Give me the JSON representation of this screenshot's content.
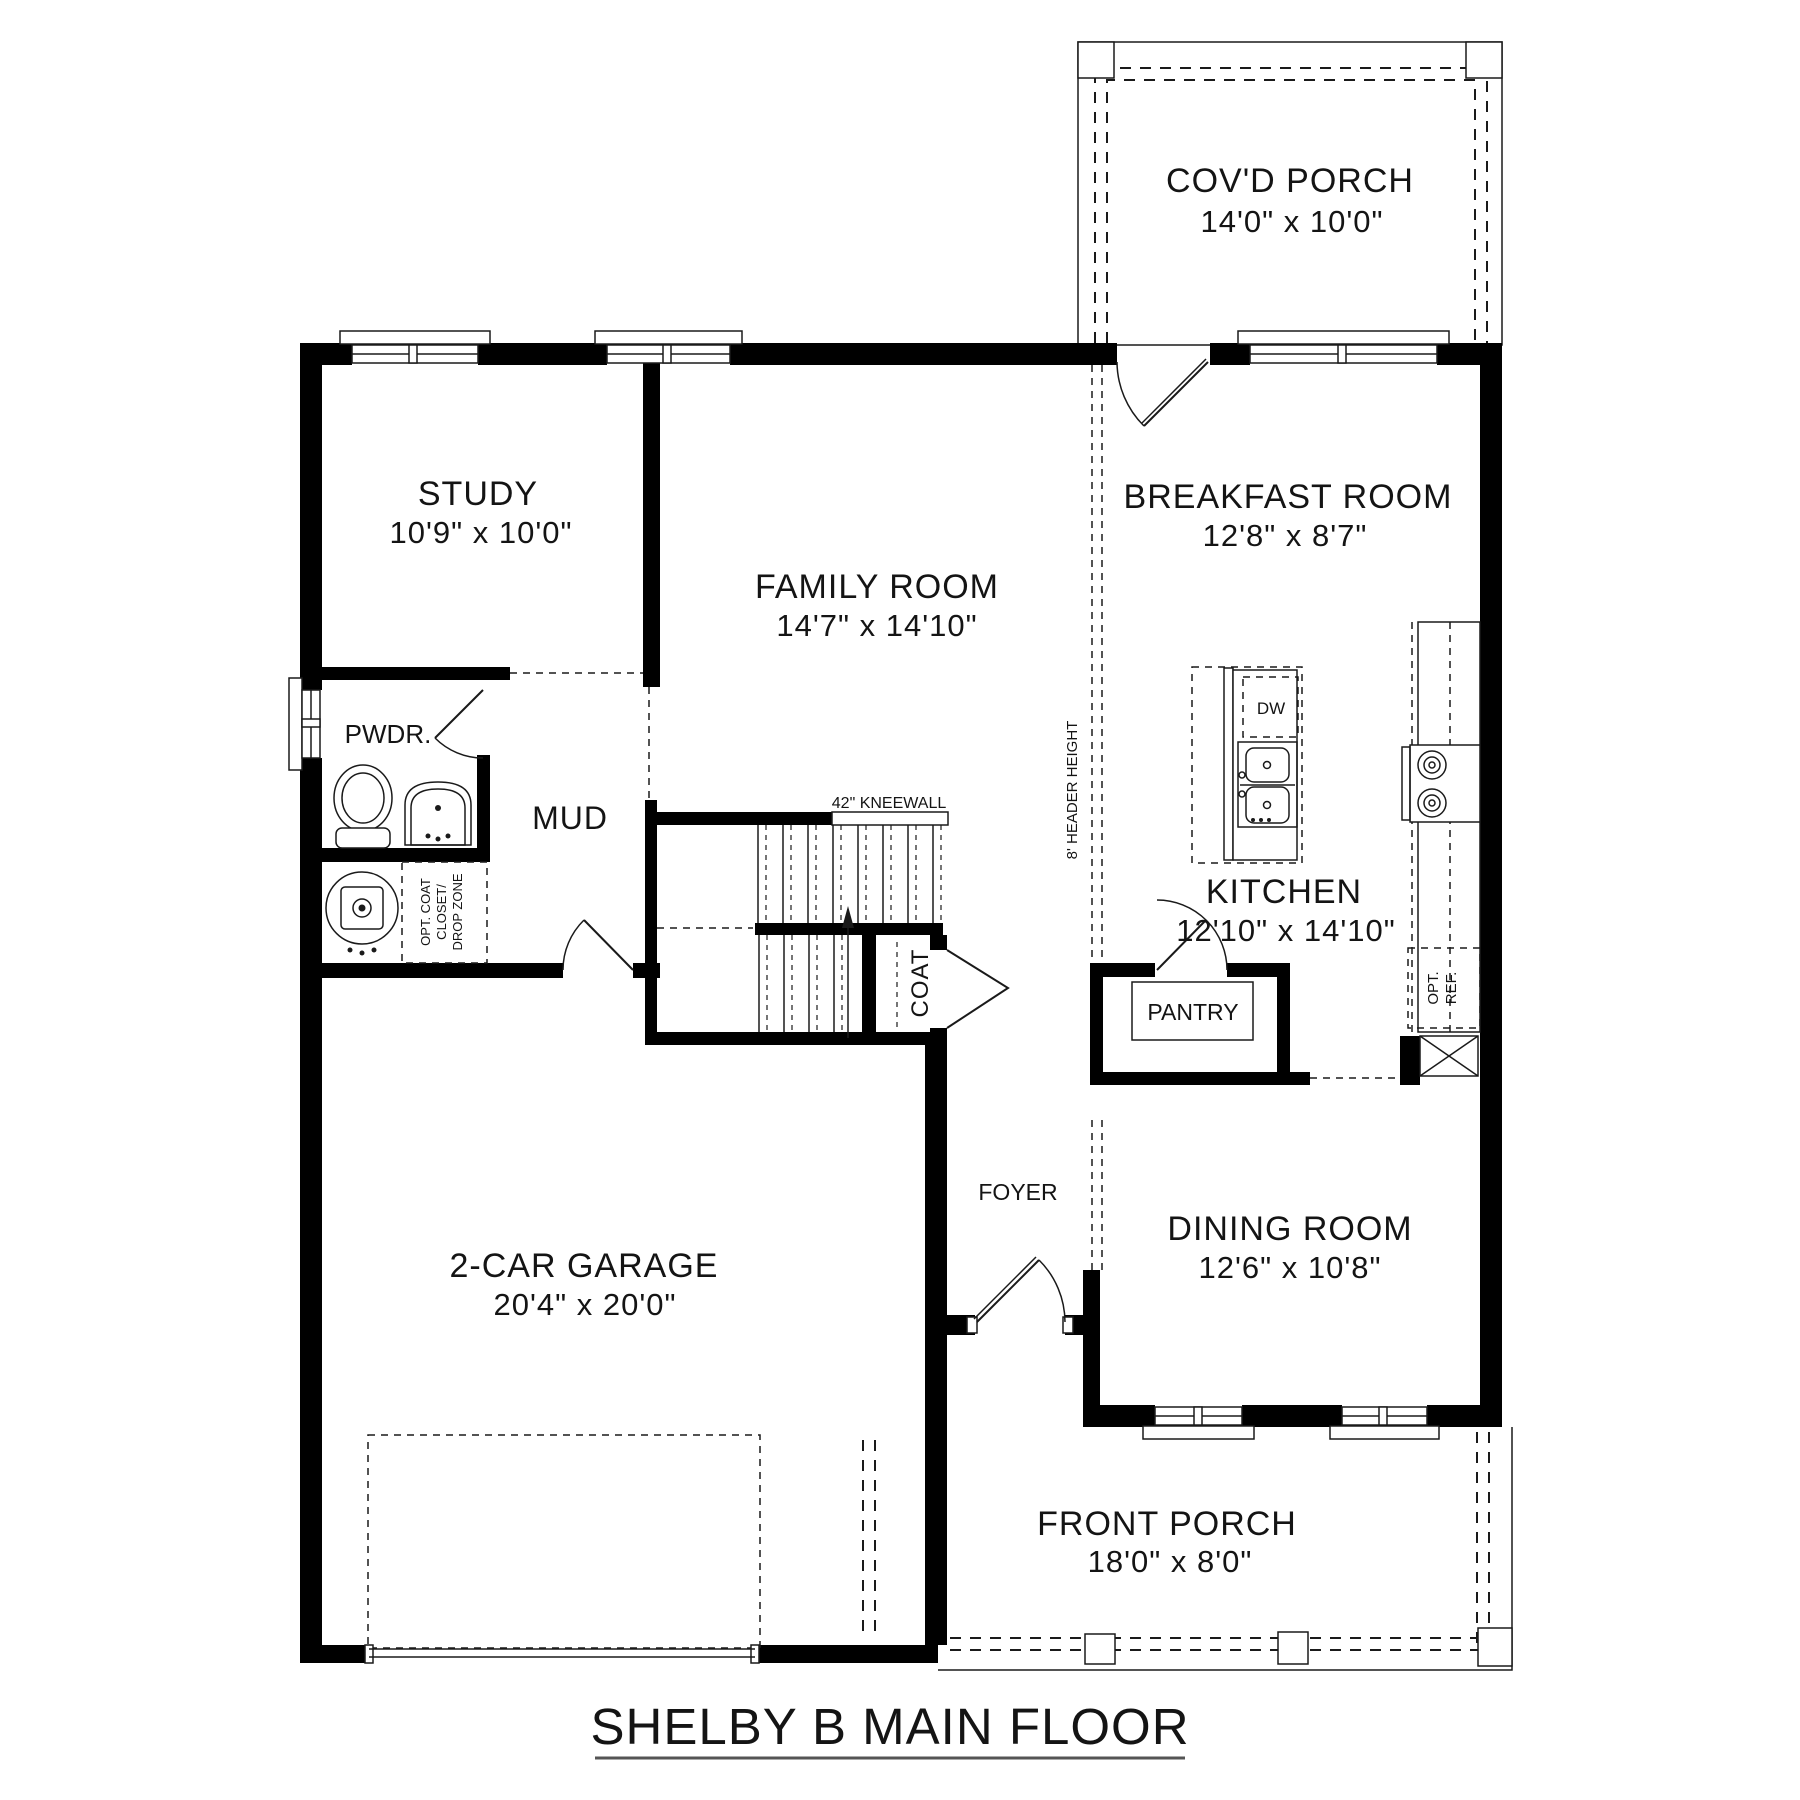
{
  "title": "SHELBY B MAIN FLOOR",
  "rooms": {
    "covd_porch": {
      "name": "COV'D PORCH",
      "dims": "14'0\" x 10'0\""
    },
    "study": {
      "name": "STUDY",
      "dims": "10'9\" x 10'0\""
    },
    "family": {
      "name": "FAMILY ROOM",
      "dims": "14'7\" x 14'10\""
    },
    "breakfast": {
      "name": "BREAKFAST ROOM",
      "dims": "12'8\" x 8'7\""
    },
    "kitchen": {
      "name": "KITCHEN",
      "dims": "12'10\" x 14'10\""
    },
    "dining": {
      "name": "DINING ROOM",
      "dims": "12'6\" x 10'8\""
    },
    "garage": {
      "name": "2-CAR GARAGE",
      "dims": "20'4\" x 20'0\""
    },
    "front_porch": {
      "name": "FRONT PORCH",
      "dims": "18'0\" x 8'0\""
    },
    "pwdr": {
      "name": "PWDR."
    },
    "mud": {
      "name": "MUD"
    },
    "pantry": {
      "name": "PANTRY"
    },
    "foyer": {
      "name": "FOYER"
    },
    "coat": {
      "name": "COAT"
    }
  },
  "annotations": {
    "kneewall": "42\" KNEEWALL",
    "header_height": "8' HEADER HEIGHT",
    "opt_coat_1": "OPT. COAT",
    "opt_coat_2": "CLOSET/",
    "opt_coat_3": "DROP ZONE",
    "dw": "DW",
    "opt_ref_1": "OPT.",
    "opt_ref_2": "REF."
  },
  "colors": {
    "wall": "#000000",
    "line": "#1a1a1a",
    "background": "#ffffff"
  }
}
